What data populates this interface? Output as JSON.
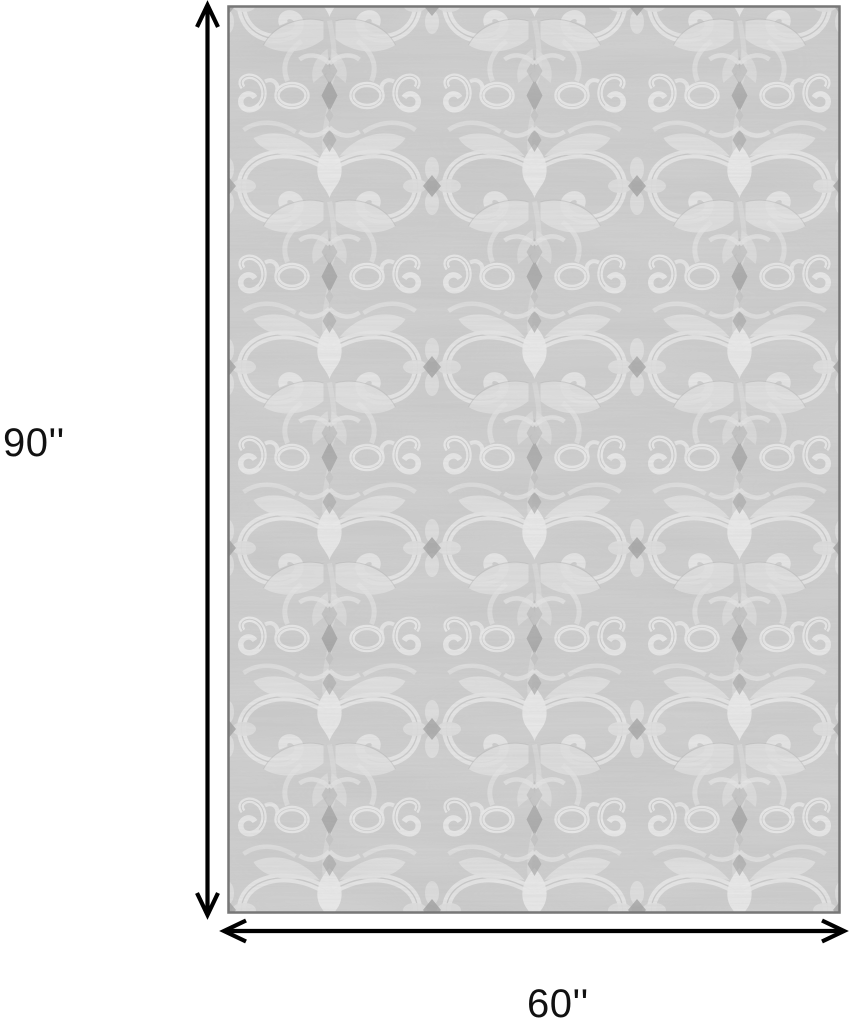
{
  "figure": {
    "kind": "product-dimension-diagram",
    "labels": {
      "height": "90''",
      "width": "60''"
    }
  },
  "colors": {
    "background": "#ffffff",
    "arrow": "#000000",
    "label_text": "#111111",
    "rug_base": "#cacaca",
    "rug_motif_light": "#e7e7e7",
    "rug_motif_mid": "#dedede",
    "rug_motif_dark": "#9d9d9d",
    "rug_edge": "#777777"
  },
  "icons": {
    "vertical_arrow": "double-headed-vertical-arrow-icon",
    "horizontal_arrow": "double-headed-horizontal-arrow-icon"
  }
}
